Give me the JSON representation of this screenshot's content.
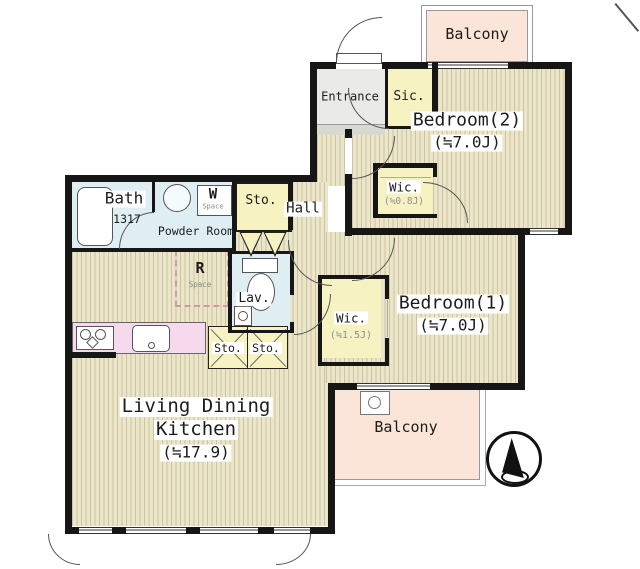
{
  "plan": {
    "balcony_top": "Balcony",
    "balcony_bottom": "Balcony",
    "entrance": "Entrance",
    "sic": "Sic.",
    "bedroom2": "Bedroom(2)",
    "bedroom2_size": "(≒7.0J)",
    "wic_small": "Wic.",
    "wic_small_size": "(≒0.8J)",
    "hall": "Hall",
    "bath": "Bath",
    "bath_size": "1317",
    "powder_room": "Powder Room",
    "w_space_initial": "W",
    "w_space_sub": "Space",
    "sto_hall": "Sto.",
    "r_space_initial": "R",
    "r_space_sub": "Space",
    "lav": "Lav.",
    "wic_large": "Wic.",
    "wic_large_size": "(≒1.5J)",
    "bedroom1": "Bedroom(1)",
    "bedroom1_size": "(≒7.0J)",
    "sto_a": "Sto.",
    "sto_b": "Sto.",
    "ldk_line1": "Living Dining",
    "ldk_line2": "Kitchen",
    "ldk_size": "(≒17.9)"
  },
  "colors": {
    "wall": "#161616",
    "floorbase": "#ebe6cb",
    "stripe": "#cdc49c",
    "yellow": "#f7f2c2",
    "blue": "#dfeef3",
    "peach": "#fbe4d8",
    "pink": "#f7d9ee",
    "entrance": "#eaeae6"
  }
}
